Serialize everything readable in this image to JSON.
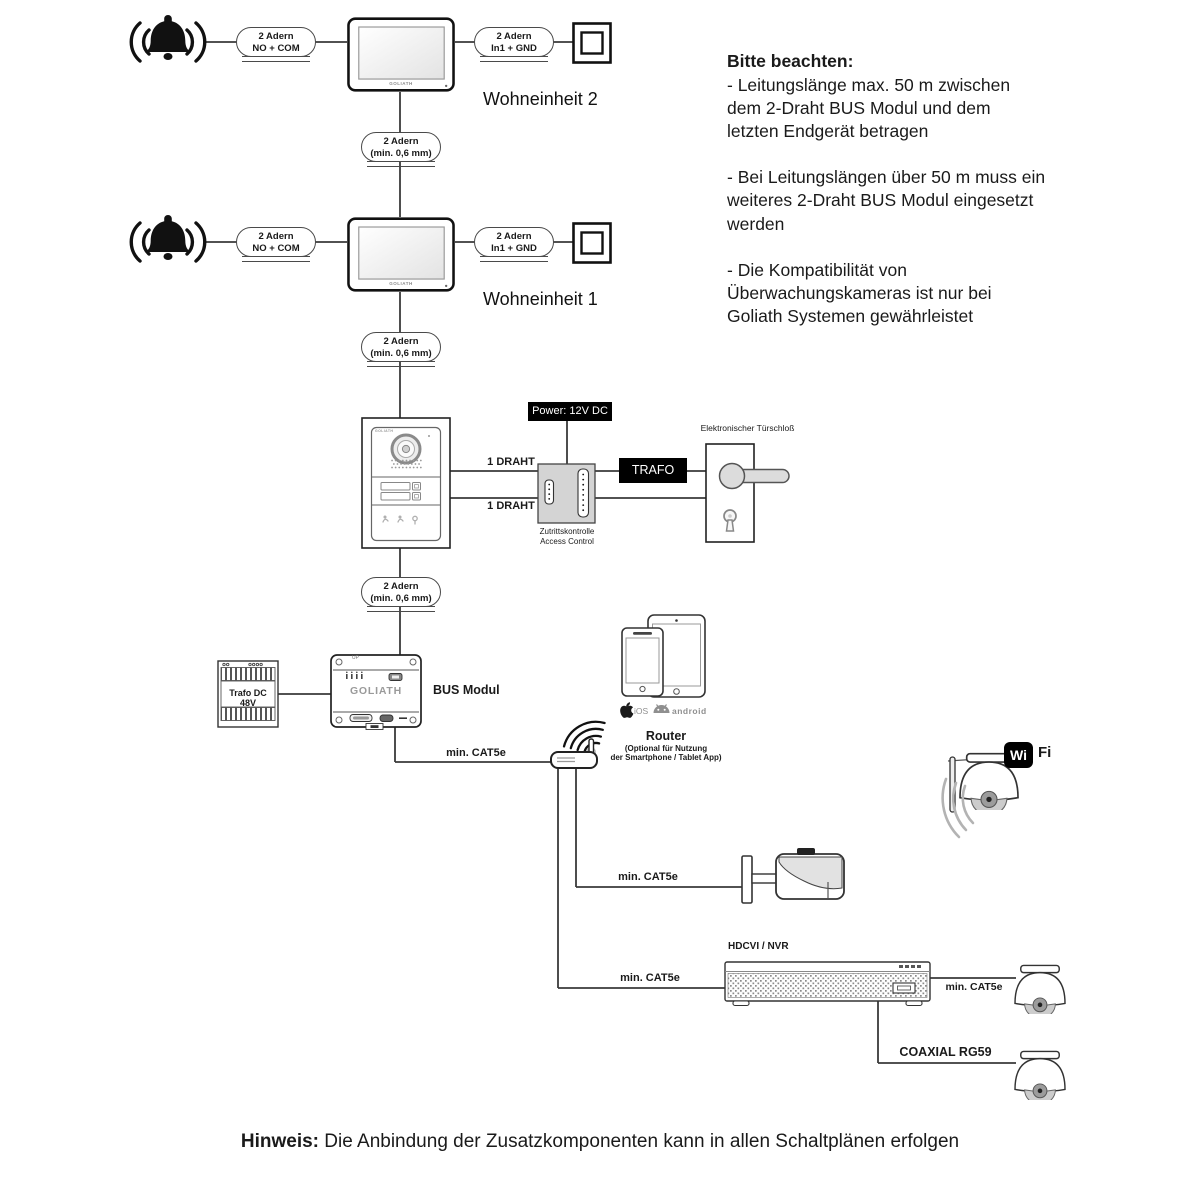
{
  "colors": {
    "line": "#3a3a3a",
    "black_box": "#000000",
    "access_fill": "#d4d4d4",
    "handle_fill": "#dcdcdc"
  },
  "units": [
    {
      "label": "Wohneinheit 2",
      "bell_cable": "2 Adern\nNO + COM",
      "button_cable": "2 Adern\nIn1 + GND",
      "riser_cable": "2 Adern\n(min. 0,6 mm)",
      "monitor_brand": "GOLIATH"
    },
    {
      "label": "Wohneinheit 1",
      "bell_cable": "2 Adern\nNO + COM",
      "button_cable": "2 Adern\nIn1 + GND",
      "riser_cable": "2 Adern\n(min. 0,6 mm)",
      "monitor_brand": "GOLIATH"
    }
  ],
  "door_station": {
    "brand": "GOLIATH",
    "riser_cable": "2 Adern\n(min. 0,6 mm)",
    "wire_top": "1 DRAHT",
    "wire_bottom": "1 DRAHT"
  },
  "access": {
    "power_label": "Power: 12V DC",
    "name_de": "Zutrittskontrolle",
    "name_en": "Access Control",
    "trafo_label": "TRAFO",
    "lock_label": "Elektronischer Türschloß"
  },
  "bus": {
    "trafo_label": "Trafo DC 48V",
    "module_label": "BUS Modul",
    "brand": "GOLIATH",
    "up_label": "UP"
  },
  "network": {
    "bus_router_cable": "min. CAT5e",
    "router_label": "Router",
    "router_note_line1": "(Optional für Nutzung",
    "router_note_line2": "der Smartphone / Tablet App)",
    "ios_label": "iOS",
    "android_label": "android",
    "wifi_wi": "Wi",
    "wifi_fi": "Fi",
    "bullet_cable": "min. CAT5e",
    "nvr_label": "HDCVI / NVR",
    "nvr_cable": "min. CAT5e",
    "dome_cable": "min. CAT5e",
    "coax_cable": "COAXIAL RG59"
  },
  "notes": {
    "title": "Bitte beachten:",
    "paragraphs": [
      "- Leitungslänge max. 50 m zwischen\ndem 2-Draht BUS Modul und dem\nletzten Endgerät betragen",
      "- Bei Leitungslängen über 50 m muss ein\nweiteres 2-Draht BUS Modul eingesetzt\nwerden",
      "- Die Kompatibilität von\nÜberwachungskameras ist nur bei\nGoliath Systemen gewährleistet"
    ]
  },
  "footer": {
    "prefix": "Hinweis:",
    "text": " Die Anbindung der Zusatzkomponenten kann in allen Schaltplänen erfolgen"
  }
}
